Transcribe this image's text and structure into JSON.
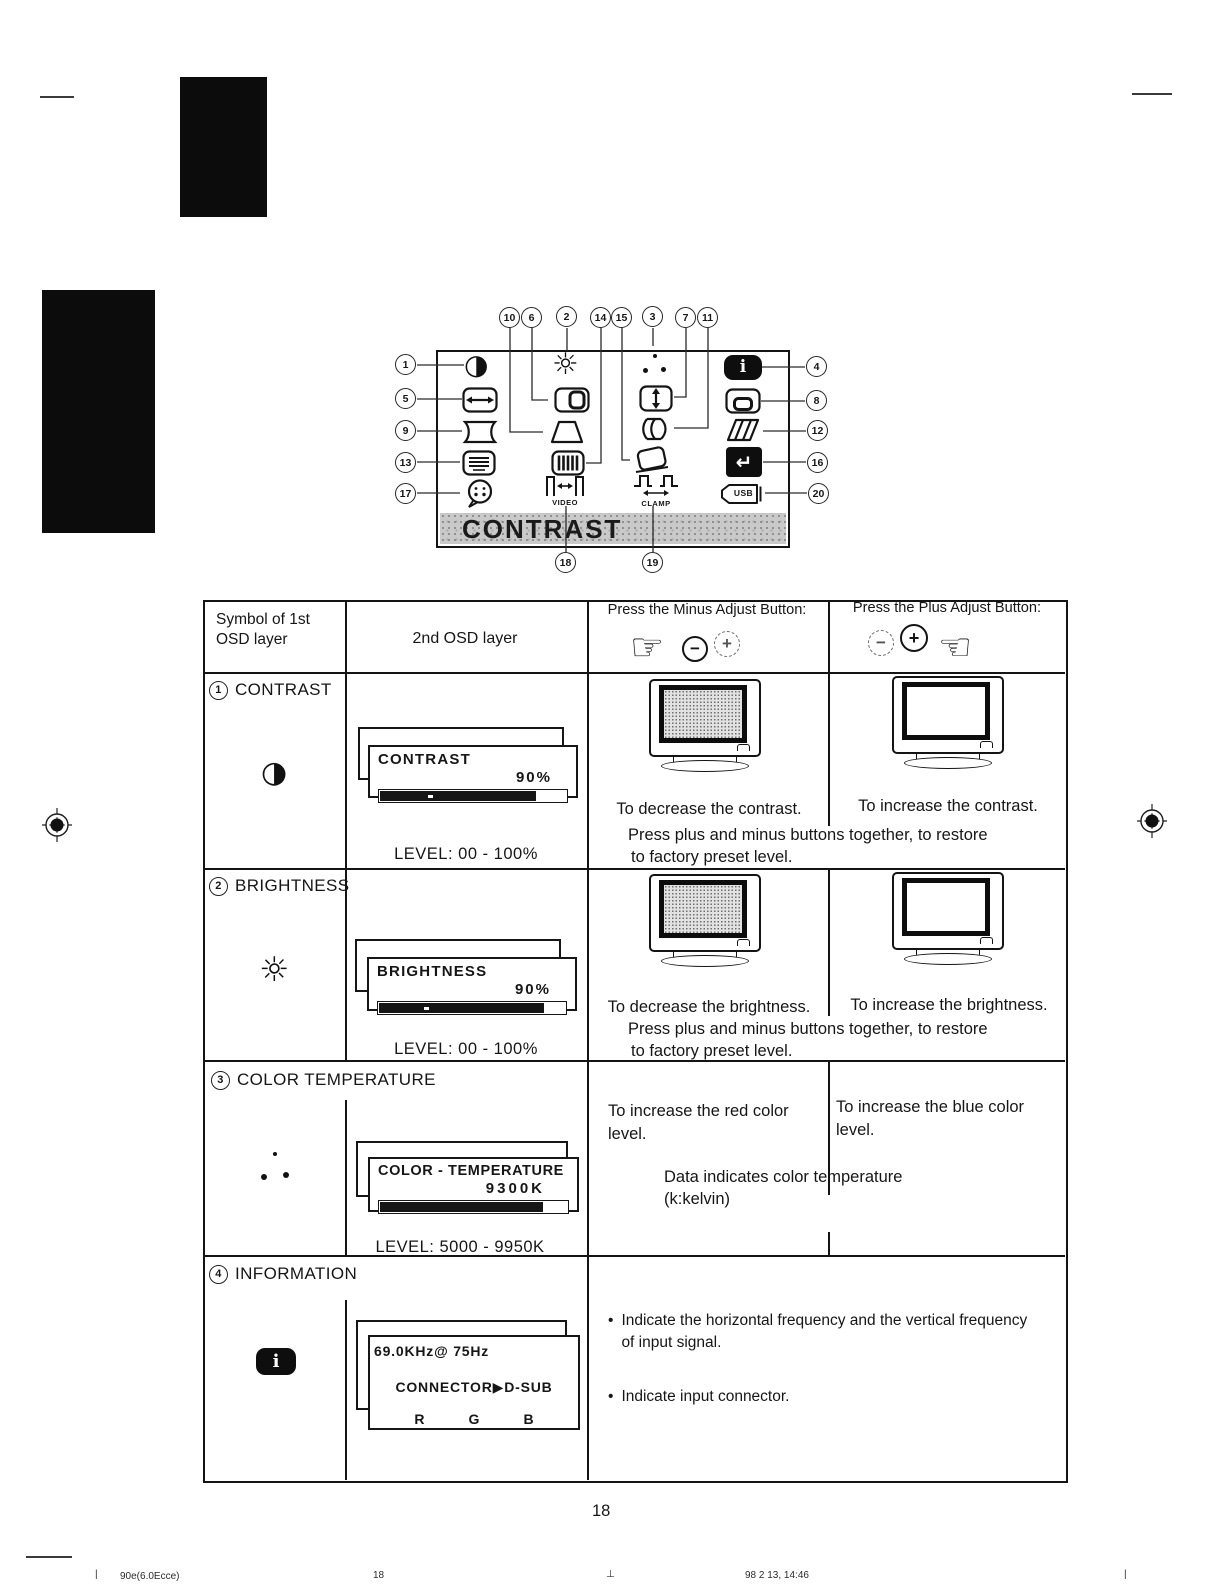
{
  "page": {
    "number": "18",
    "footer": {
      "left_tick": "|",
      "doc_code": "90e(6.0Ecce)",
      "page": "18",
      "center_mark": "⊥",
      "datetime": "98 2 13, 14:46",
      "right_tick": "|"
    }
  },
  "diagram": {
    "banner": "CONTRAST",
    "callouts": [
      "1",
      "5",
      "9",
      "13",
      "17",
      "4",
      "8",
      "12",
      "16",
      "20",
      "10",
      "6",
      "2",
      "14",
      "15",
      "3",
      "7",
      "11",
      "18",
      "19"
    ],
    "glyphs": {
      "contrast": "◑",
      "brightness": "☼",
      "info": "i",
      "recall": "↵",
      "video_label": "VIDEO",
      "clamp_label": "CLAMP",
      "usb_label": "USB"
    }
  },
  "table": {
    "header": {
      "col1": "Symbol of 1st OSD layer",
      "col2": "2nd OSD layer",
      "col3": "Press the Minus Adjust Button:",
      "col4": "Press the Plus Adjust Button:",
      "minus": "−",
      "plus": "+",
      "hand_right": "☞",
      "hand_left": "☜"
    },
    "rows": [
      {
        "num": "1",
        "heading": "CONTRAST",
        "symbol_glyph": "◑",
        "osd": {
          "title": "CONTRAST",
          "value": "90%",
          "bar_pct": 83
        },
        "level": "LEVEL: 00 - 100%",
        "minus_caption": "To decrease the contrast.",
        "plus_caption": "To increase the contrast.",
        "note_line1": "Press plus and minus buttons together, to restore",
        "note_line2": "to factory preset level."
      },
      {
        "num": "2",
        "heading": "BRIGHTNESS",
        "symbol_glyph": "☼",
        "osd": {
          "title": "BRIGHTNESS",
          "value": "90%",
          "bar_pct": 88
        },
        "level": "LEVEL: 00 - 100%",
        "minus_caption": "To decrease the brightness.",
        "plus_caption": "To increase the brightness.",
        "note_line1": "Press plus and minus buttons together, to restore",
        "note_line2": "to factory preset level."
      },
      {
        "num": "3",
        "heading": "COLOR TEMPERATURE",
        "osd": {
          "title": "COLOR - TEMPERATURE",
          "value": "9300K",
          "bar_pct": 86
        },
        "level": "LEVEL: 5000 - 9950K",
        "minus_caption": "To increase the red color level.",
        "plus_caption": "To increase the blue color level.",
        "note_line1": "Data indicates color temperature",
        "note_line2": "(k:kelvin)"
      },
      {
        "num": "4",
        "heading": "INFORMATION",
        "symbol_glyph": "i",
        "osd_info": {
          "line1": "69.0KHz@ 75Hz",
          "line2_left": "CONNECTOR",
          "line2_arrow": "▶",
          "line2_right": "D-SUB",
          "r": "R",
          "g": "G",
          "b": "B"
        },
        "bullet_char": "•",
        "bullets": [
          "Indicate the horizontal frequency and the vertical frequency of input signal.",
          "Indicate input connector."
        ]
      }
    ]
  }
}
